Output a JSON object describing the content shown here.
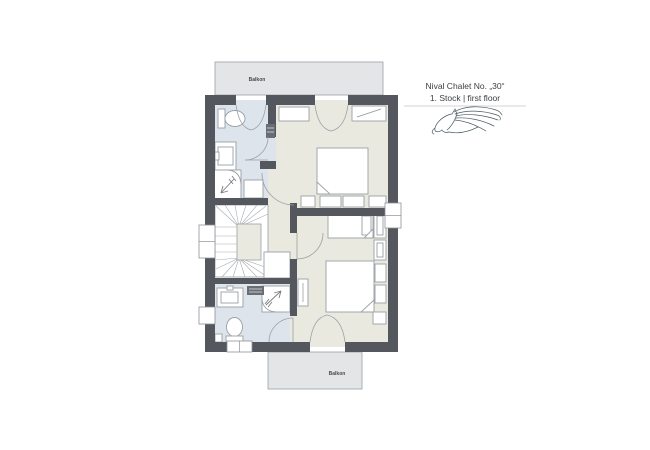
{
  "header": {
    "line1": "Nival Chalet No. „30“",
    "line2": "1. Stock | first floor",
    "logo_icon": "horse-logo"
  },
  "plan": {
    "balcony_top": {
      "label": "Balkon"
    },
    "balcony_bottom": {
      "label": "Balkon"
    },
    "fixtures": [
      "staircase-winder",
      "toilet",
      "sink",
      "shower",
      "towel-radiator",
      "double-bed",
      "single-bed",
      "pillow",
      "nightstand",
      "wardrobe",
      "french-door",
      "door-swing",
      "window",
      "radiator"
    ]
  },
  "colors": {
    "wall": "#54575d",
    "bathroom": "#dde4ec",
    "room": "#e9e9df",
    "balcony": "#e4e5e7",
    "outline": "#9aa0a6",
    "text": "#3c4043",
    "logo": "#4a5a63",
    "label": "#4a4a4a"
  }
}
